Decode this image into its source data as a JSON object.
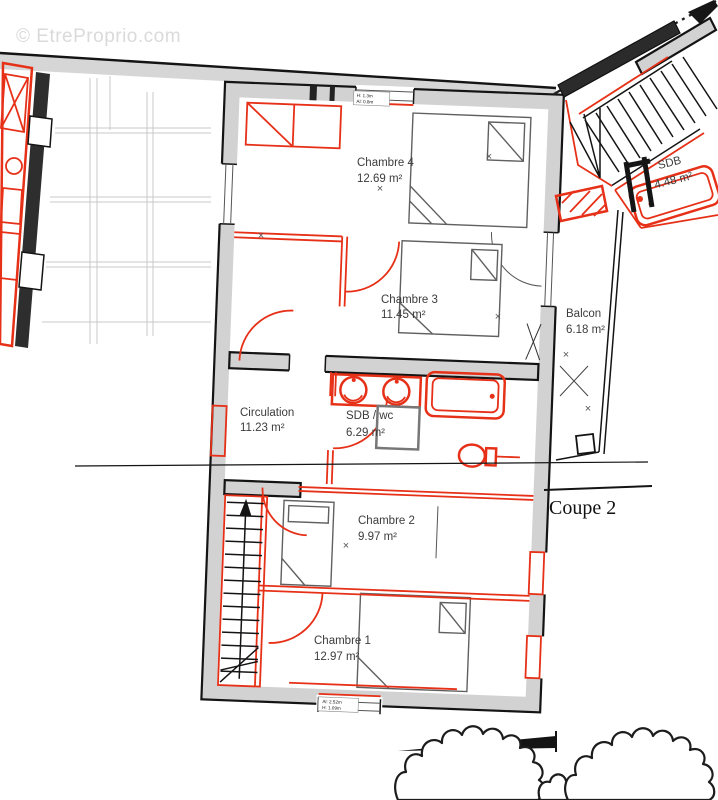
{
  "watermark": "© EtreProprio.com",
  "plan": {
    "rooms": {
      "chambre4": {
        "label": "Chambre 4",
        "area": "12.69 m²"
      },
      "chambre3": {
        "label": "Chambre 3",
        "area": "11.45 m²"
      },
      "sdb_annex": {
        "label": "SDB",
        "area": "4.48 m²"
      },
      "balcon": {
        "label": "Balcon",
        "area": "6.18 m²"
      },
      "circulation": {
        "label": "Circulation",
        "area": "11.23 m²"
      },
      "sdb_wc": {
        "label": "SDB / wc",
        "area": "6.29 m²"
      },
      "chambre2": {
        "label": "Chambre 2",
        "area": "9.97 m²"
      },
      "chambre1": {
        "label": "Chambre 1",
        "area": "12.97 m²"
      }
    },
    "section_label": "Coupe 2",
    "annotations": {
      "window_top": {
        "line1": "H: 1.3m",
        "line2": "Al: 0.8m"
      },
      "door_bottom": {
        "line1": "Al: 2.52m",
        "line2": "H: 1.09m"
      }
    },
    "cross_mark": "×"
  },
  "colors": {
    "accent_red": "#e63118",
    "wall_gray": "#d2d2d2",
    "line_black": "#141414",
    "faint_gray": "#c9c9c9",
    "watermark_gray": "#dadada",
    "text_gray": "#3c3c3c"
  }
}
